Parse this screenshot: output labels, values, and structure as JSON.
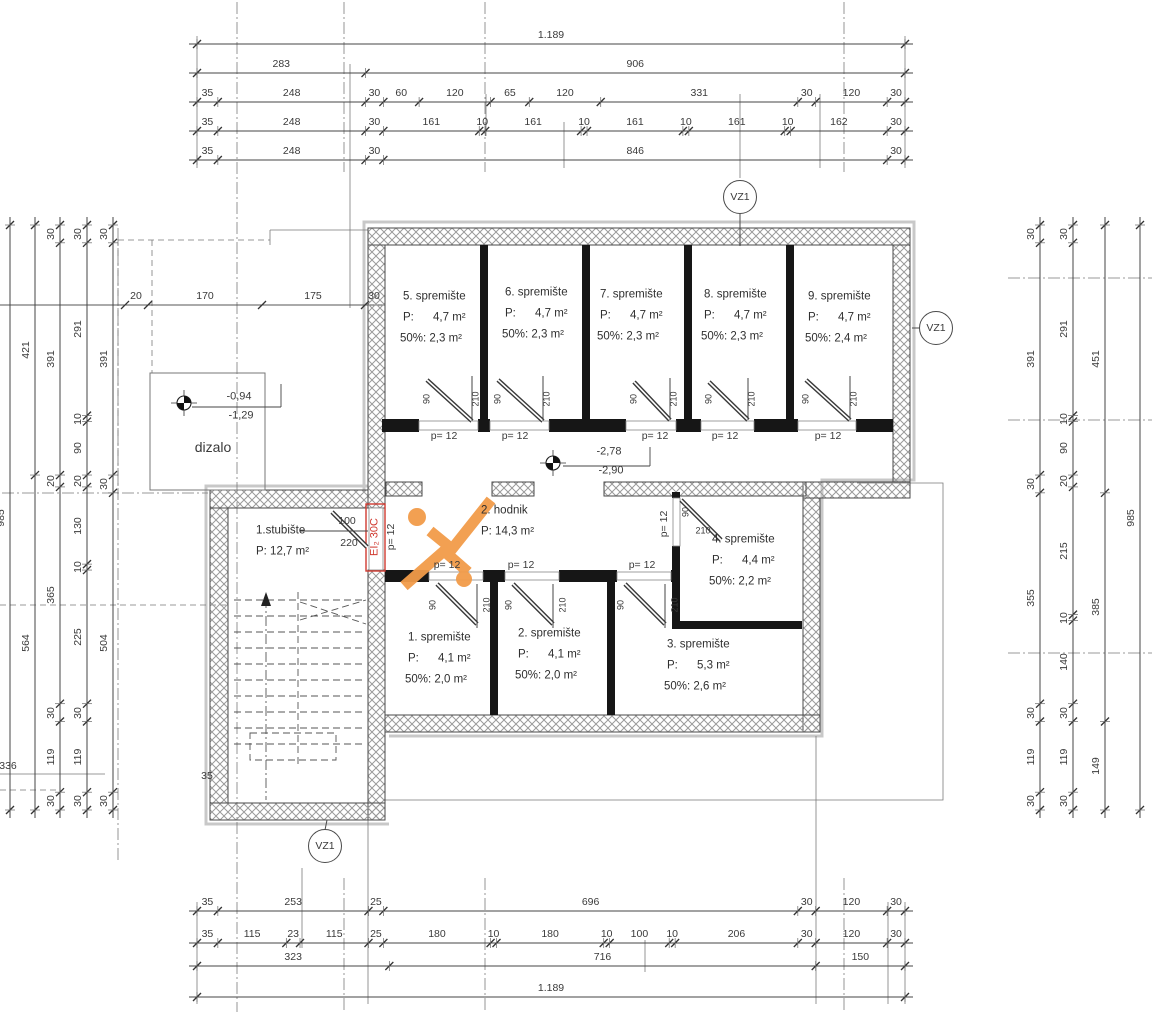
{
  "drawing": {
    "width": 1154,
    "height": 1024,
    "kind": "basement storage floor plan"
  },
  "colors": {
    "accent_orange": "#F29B49",
    "fire_red": "#D03A30",
    "wall_black": "#161616",
    "hatch_gray": "#9a9a9a",
    "line_gray": "#555555",
    "text_gray": "#3a3a3a"
  },
  "callouts": {
    "label": "VZ1",
    "positions": [
      {
        "x": 740,
        "y": 197
      },
      {
        "x": 936,
        "y": 328
      },
      {
        "x": 325,
        "y": 846
      }
    ]
  },
  "levels": [
    {
      "above": "-2,78",
      "below": "-2,90",
      "x": 609,
      "y": 461
    },
    {
      "above": "-0,94",
      "below": "-1,29",
      "x": 239,
      "y": 406
    }
  ],
  "fire_rating": "EI₂ 30C",
  "elevator_label": "dizalo",
  "rooms": [
    {
      "name": "5. spremište",
      "area": "P:      4,7 m²",
      "half": "50%: 2,3 m²",
      "x": 403,
      "y": 297
    },
    {
      "name": "6. spremište",
      "area": "P:      4,7 m²",
      "half": "50%: 2,3 m²",
      "x": 505,
      "y": 293
    },
    {
      "name": "7. spremište",
      "area": "P:      4,7 m²",
      "half": "50%: 2,3 m²",
      "x": 600,
      "y": 295
    },
    {
      "name": "8. spremište",
      "area": "P:      4,7 m²",
      "half": "50%: 2,3 m²",
      "x": 704,
      "y": 295
    },
    {
      "name": "9. spremište",
      "area": "P:      4,7 m²",
      "half": "50%: 2,4 m²",
      "x": 808,
      "y": 297
    },
    {
      "name": "2. hodnik",
      "area": "P: 14,3 m²",
      "x": 481,
      "y": 511
    },
    {
      "name": "4. spremište",
      "area": "P:      4,4 m²",
      "half": "50%: 2,2 m²",
      "x": 712,
      "y": 540
    },
    {
      "name": "1. spremište",
      "area": "P:      4,1 m²",
      "half": "50%: 2,0 m²",
      "x": 408,
      "y": 638
    },
    {
      "name": "2. spremište",
      "area": "P:      4,1 m²",
      "half": "50%: 2,0 m²",
      "x": 518,
      "y": 634
    },
    {
      "name": "3. spremište",
      "area": "P:      5,3 m²",
      "half": "50%: 2,6 m²",
      "x": 667,
      "y": 645
    },
    {
      "name": "1.stubište",
      "area": "P: 12,7 m²",
      "x": 256,
      "y": 531
    }
  ],
  "annotations": [
    {
      "t": "p= 12",
      "x": 444,
      "y": 436
    },
    {
      "t": "p= 12",
      "x": 515,
      "y": 436
    },
    {
      "t": "p= 12",
      "x": 655,
      "y": 436
    },
    {
      "t": "p= 12",
      "x": 725,
      "y": 436
    },
    {
      "t": "p= 12",
      "x": 828,
      "y": 436
    },
    {
      "t": "90",
      "x": 427,
      "y": 399,
      "r": -90,
      "s": 9
    },
    {
      "t": "210",
      "x": 476,
      "y": 399,
      "r": -90,
      "s": 9
    },
    {
      "t": "90",
      "x": 498,
      "y": 399,
      "r": -90,
      "s": 9
    },
    {
      "t": "210",
      "x": 547,
      "y": 399,
      "r": -90,
      "s": 9
    },
    {
      "t": "90",
      "x": 634,
      "y": 399,
      "r": -90,
      "s": 9
    },
    {
      "t": "210",
      "x": 674,
      "y": 399,
      "r": -90,
      "s": 9
    },
    {
      "t": "90",
      "x": 709,
      "y": 399,
      "r": -90,
      "s": 9
    },
    {
      "t": "210",
      "x": 752,
      "y": 399,
      "r": -90,
      "s": 9
    },
    {
      "t": "90",
      "x": 806,
      "y": 399,
      "r": -90,
      "s": 9
    },
    {
      "t": "210",
      "x": 854,
      "y": 399,
      "r": -90,
      "s": 9
    },
    {
      "t": "p= 12",
      "x": 447,
      "y": 565
    },
    {
      "t": "p= 12",
      "x": 521,
      "y": 565
    },
    {
      "t": "p= 12",
      "x": 642,
      "y": 565
    },
    {
      "t": "90",
      "x": 433,
      "y": 605,
      "r": -90,
      "s": 9
    },
    {
      "t": "210",
      "x": 487,
      "y": 605,
      "r": -90,
      "s": 9
    },
    {
      "t": "90",
      "x": 509,
      "y": 605,
      "r": -90,
      "s": 9
    },
    {
      "t": "210",
      "x": 563,
      "y": 605,
      "r": -90,
      "s": 9
    },
    {
      "t": "90",
      "x": 621,
      "y": 605,
      "r": -90,
      "s": 9
    },
    {
      "t": "210",
      "x": 675,
      "y": 605,
      "r": -90,
      "s": 9
    },
    {
      "t": "p= 12",
      "x": 664,
      "y": 524,
      "r": -90
    },
    {
      "t": "90",
      "x": 686,
      "y": 512,
      "r": -90,
      "s": 9
    },
    {
      "t": "210",
      "x": 703,
      "y": 531,
      "s": 9
    },
    {
      "t": "p= 12",
      "x": 391,
      "y": 537,
      "r": -90
    },
    {
      "t": "100",
      "x": 347,
      "y": 521
    },
    {
      "t": "220",
      "x": 349,
      "y": 543
    },
    {
      "t": "35",
      "x": 207,
      "y": 776
    },
    {
      "t": "336",
      "x": 8,
      "y": 766
    },
    {
      "t": "20",
      "x": 136,
      "y": 296
    },
    {
      "t": "170",
      "x": 205,
      "y": 296
    },
    {
      "t": "175",
      "x": 313,
      "y": 296
    },
    {
      "t": "30",
      "x": 374,
      "y": 296
    }
  ],
  "dimensions": {
    "top": {
      "x0": 197,
      "x1": 905,
      "rows": [
        {
          "y": 44,
          "segs": [
            1189
          ],
          "labels": [
            "1.189"
          ]
        },
        {
          "y": 73,
          "segs": [
            283,
            906
          ]
        },
        {
          "y": 102,
          "segs": [
            35,
            248,
            30,
            60,
            120,
            65,
            120,
            331,
            30,
            120,
            30
          ]
        },
        {
          "y": 131,
          "segs": [
            35,
            248,
            30,
            161,
            10,
            161,
            10,
            161,
            10,
            161,
            10,
            162,
            30
          ]
        },
        {
          "y": 160,
          "segs": [
            35,
            248,
            30,
            846,
            30
          ]
        }
      ]
    },
    "bottom": {
      "x0": 197,
      "x1": 905,
      "rows": [
        {
          "y": 911,
          "segs": [
            35,
            253,
            25,
            696,
            30,
            120,
            30
          ]
        },
        {
          "y": 943,
          "segs": [
            35,
            115,
            23,
            115,
            25,
            180,
            10,
            180,
            10,
            100,
            10,
            206,
            30,
            120,
            30
          ]
        },
        {
          "y": 966,
          "segs": [
            323,
            716,
            150
          ]
        },
        {
          "y": 997,
          "segs": [
            1189
          ],
          "labels": [
            "1.189"
          ]
        }
      ]
    },
    "left": {
      "y0": 225,
      "y1": 810,
      "cols": [
        {
          "x": 10,
          "segs": [
            985
          ]
        },
        {
          "x": 35,
          "segs": [
            421,
            564
          ]
        },
        {
          "x": 60,
          "segs": [
            30,
            391,
            20,
            365,
            30,
            119,
            30
          ]
        },
        {
          "x": 87,
          "segs": [
            30,
            291,
            10,
            90,
            20,
            130,
            10,
            225,
            30,
            119,
            30
          ]
        },
        {
          "x": 113,
          "segs": [
            30,
            391,
            30,
            504,
            30
          ]
        }
      ]
    },
    "right": {
      "y0": 225,
      "y1": 810,
      "cols": [
        {
          "x": 1040,
          "segs": [
            30,
            391,
            30,
            355,
            30,
            119,
            30
          ]
        },
        {
          "x": 1073,
          "segs": [
            30,
            291,
            10,
            90,
            20,
            215,
            10,
            140,
            30,
            119,
            30
          ]
        },
        {
          "x": 1105,
          "segs": [
            451,
            385,
            149
          ]
        },
        {
          "x": 1140,
          "segs": [
            985
          ]
        }
      ]
    }
  }
}
